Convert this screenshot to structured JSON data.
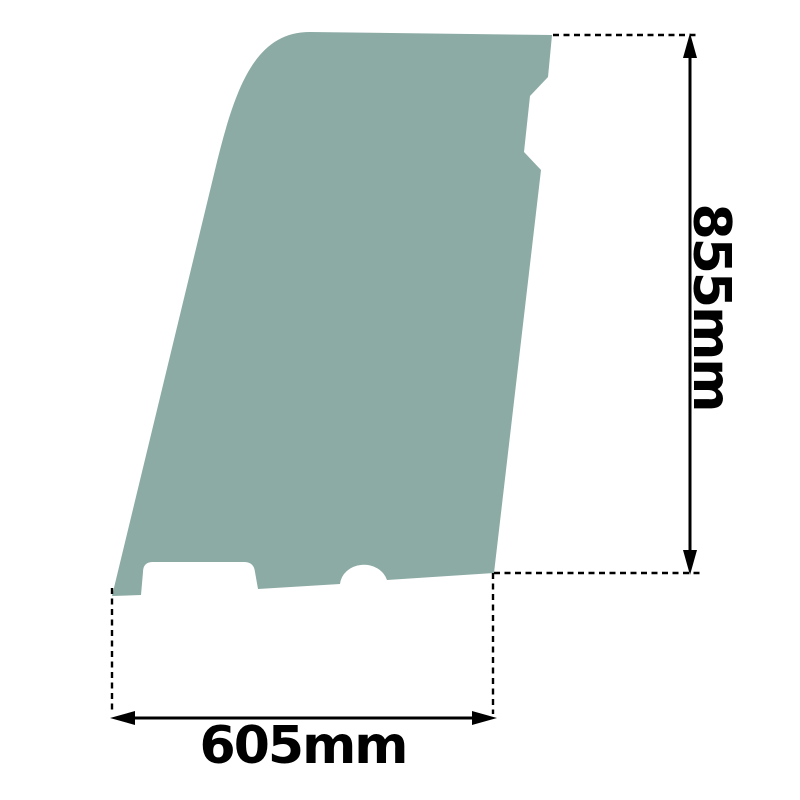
{
  "diagram": {
    "title": "glass panel dimension drawing",
    "height_label": "855mm",
    "width_label": "605mm"
  },
  "colors": {
    "background": "#ffffff",
    "glass": "#8CABA4",
    "dimension": "#000000"
  }
}
